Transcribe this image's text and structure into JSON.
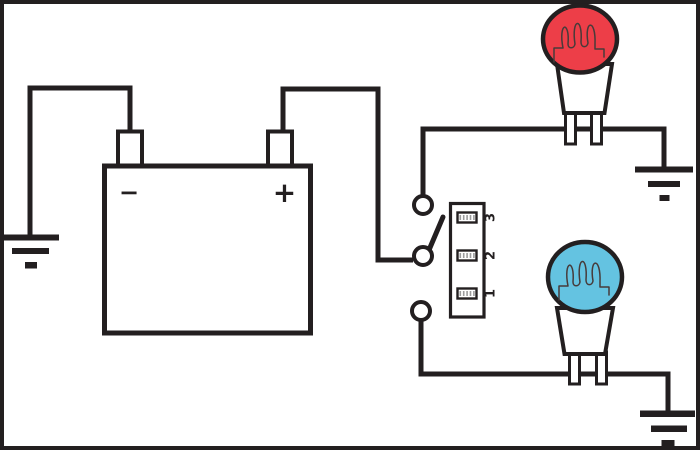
{
  "battery": {
    "negative_label": "−",
    "positive_label": "+"
  },
  "selector_switch": {
    "position_labels": [
      "1",
      "2",
      "3"
    ]
  },
  "colors": {
    "background": "#ffffff",
    "line": "#231f20",
    "top_bulb_fill": "#ed3e48",
    "bottom_bulb_fill": "#64c3e1"
  }
}
